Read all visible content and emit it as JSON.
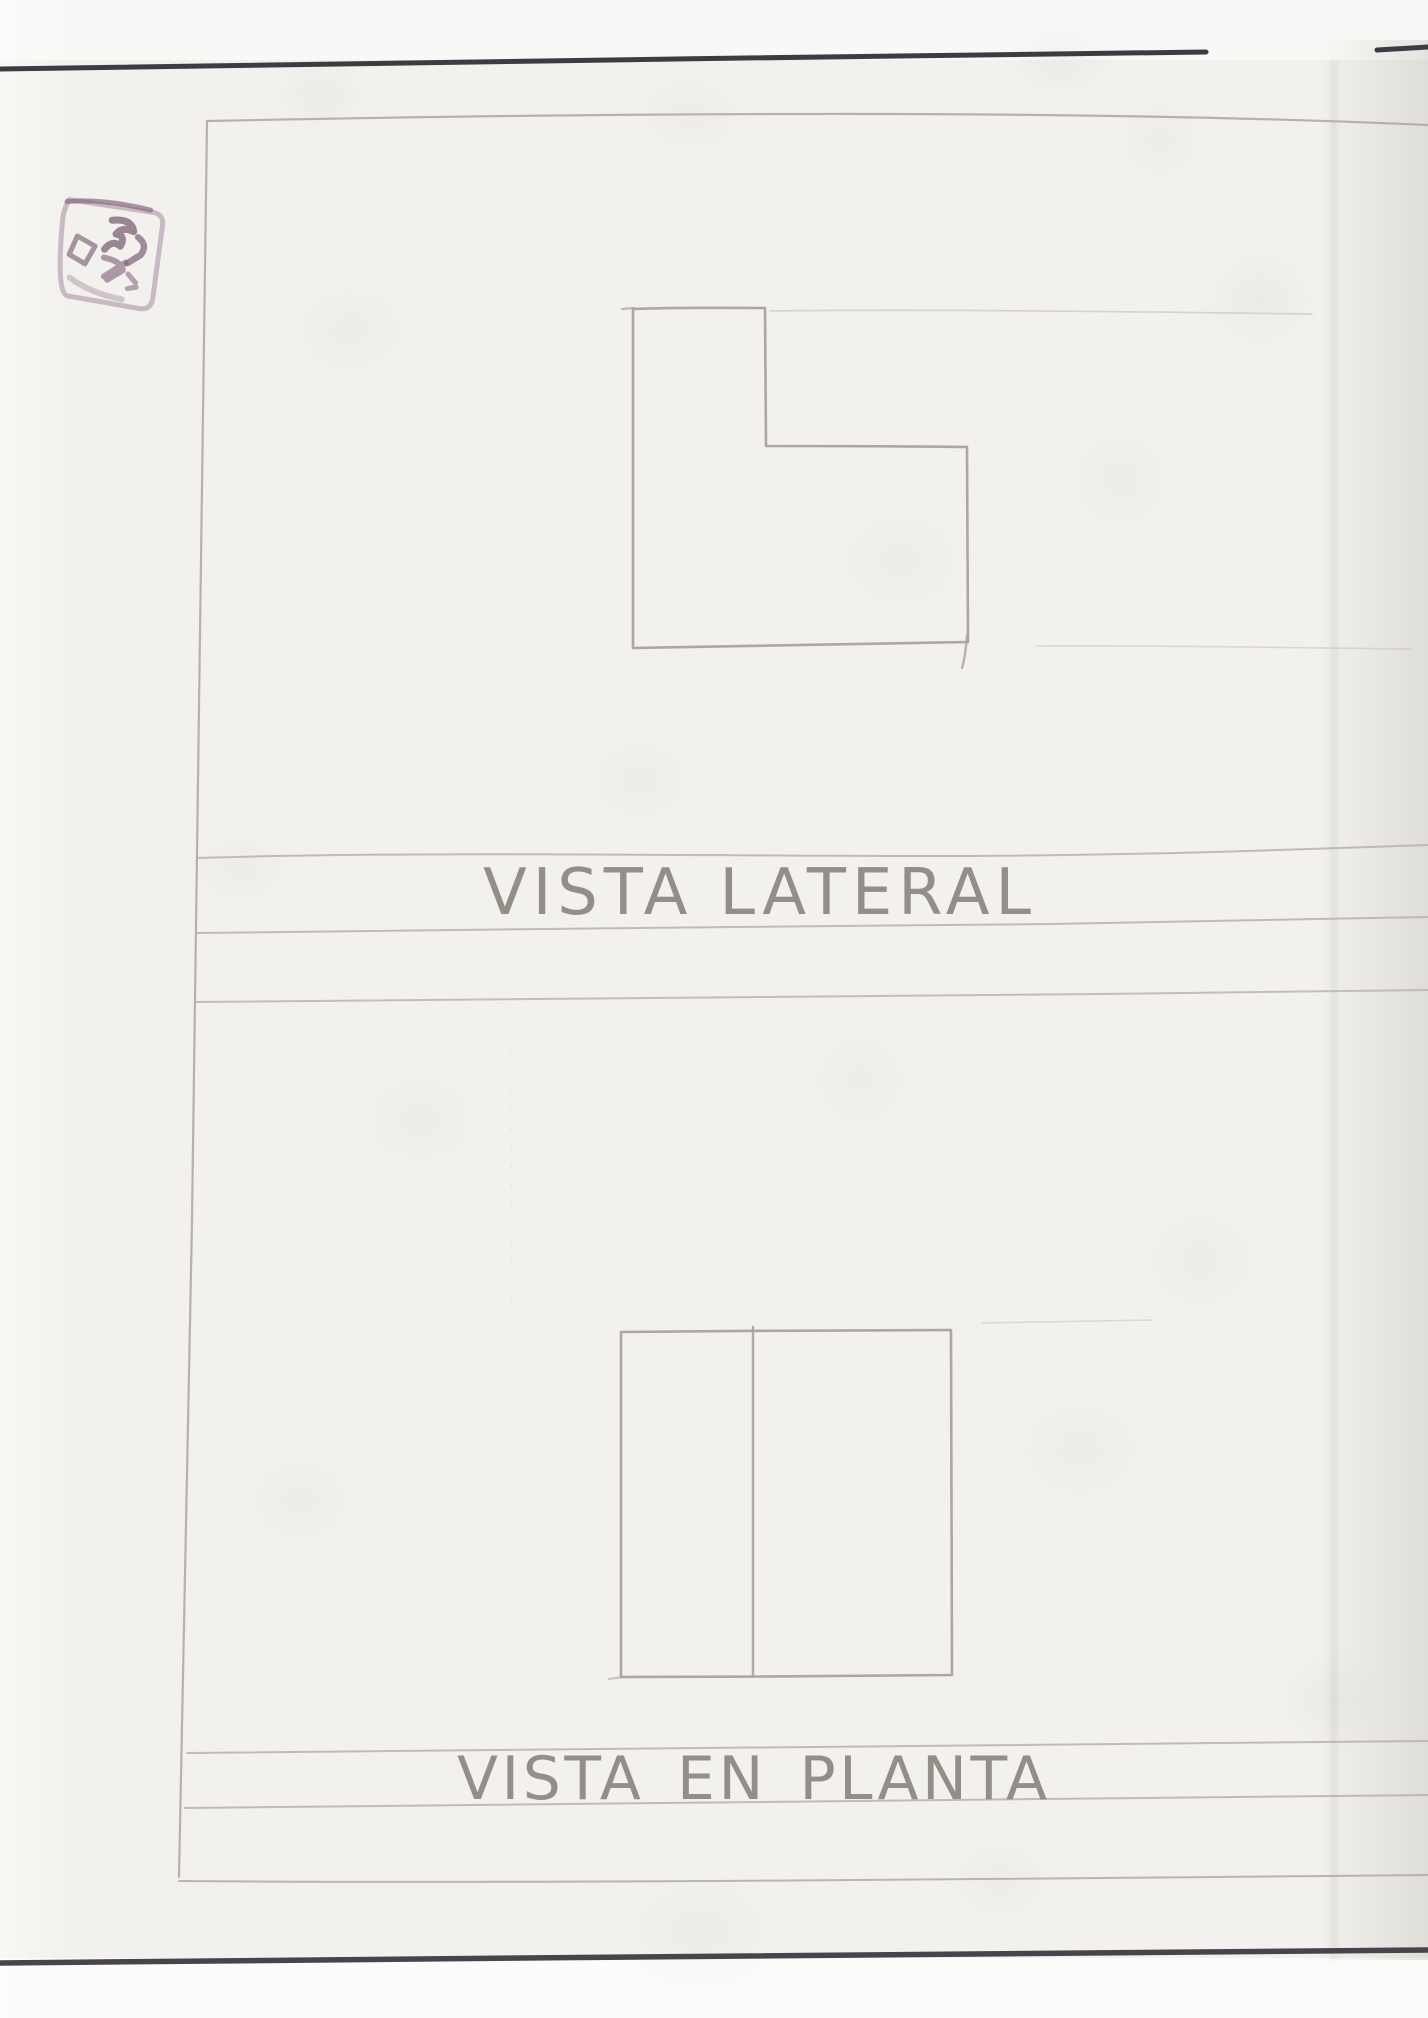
{
  "labels": {
    "side_view": "VISTA LATERAL",
    "plan_view": "VISTA EN PLANTA"
  },
  "stamp": {
    "ink_color": "#8a6a82",
    "legible": false,
    "border_d": "M -44,-52 L 40,-46 Q 52,-45 51,-33 L 47,40 Q 46,52 34,51 L -38,44 Q -50,43 -49,-31 Q -49,-42 -44,-52 Z",
    "border_accent_d": "M -46,-50 Q -10,-56 38,-48",
    "marks": [
      "M -8,-34 Q 10,-42 16,-30 Q 4,-32 0,-22 Q 10,-24 8,-12 Q -2,-16 -6,-4",
      "M 22,-26 Q 34,-22 30,-10 L 20,2",
      "M -36,-8 L -16,-4 L -20,16 L -38,12 Z",
      "M -4,4 Q 14,2 18,10 L 6,24 M 18,2 L 2,22",
      "M 24,12 L 34,18 M 28,26 L 36,22",
      "M -30,34 Q -6,42 26,38"
    ]
  },
  "colors": {
    "paper": "#f2f1ed",
    "paper_top_strip": "#f8f8f6",
    "paper_bottom_strip": "#fbfbfa",
    "page_edge_line_top": "#3f3b43",
    "page_edge_line_bottom": "#49444c",
    "pencil_figure": "#a9a29c",
    "pencil_frame": "#b0aaa4",
    "pencil_band": "#b7b1ab",
    "pencil_faint": "#c6c1bb",
    "handwriting": "#8d8680",
    "stamp_ink": "#8a6a82"
  },
  "geometry": {
    "page_edge_top_a": "M0,69 C 350,63 820,57 1206,52",
    "page_edge_top_b": "M1377,50 C 1395,49 1412,48 1428,47",
    "page_edge_bottom": "M0,1963 C 450,1959 1000,1953 1428,1950",
    "frame": {
      "left": "M207,121 C 201,600 193,1300 179,1877",
      "top": "M207,121 C 550,114 1050,108 1428,125",
      "bottom": "M179,1881 C 500,1884 1000,1879 1428,1875"
    },
    "side_section": {
      "figure_outline": "M633,309 C 680,307 740,308 765,308 L 766,446 C 830,446 900,446 967,447 L 968,642 C 860,644 740,646 633,648 Z",
      "figure_tail": "M967,636 C 966,648 965,658 962,668",
      "figure_top_overshoot": "M622,309 L 634,308",
      "construction_top": "M770,311 C 950,309 1150,312 1312,314",
      "construction_bottom": "M1036,646 C 1150,645 1300,648 1412,649",
      "band_line_1": "M197,858 C 420,851 700,856 920,856 C 1150,856 1300,849 1428,845",
      "band_line_2": "M196,933 C 450,928 800,928 1050,924 C 1250,921 1350,918 1428,917",
      "band_line_3": "M195,1002 C 450,999 800,997 1100,994 C 1250,992 1350,991 1428,990"
    },
    "plan_section": {
      "figure_outline": "M621,1332 C 730,1331 850,1330 951,1330 L 952,1675 C 850,1676 730,1677 621,1677 Z",
      "figure_divider": "M753,1327 C 753,1450 753,1560 753,1676",
      "figure_overshoot": "M609,1679 L 623,1677",
      "construction_top": "M982,1323 C 1040,1322 1100,1321 1152,1320",
      "band_top": "M187,1753 C 500,1748 900,1746 1428,1741",
      "band_bottom": "M185,1808 C 500,1804 900,1800 1428,1795"
    },
    "mid_crease": "M510,1050 C 511,1140 512,1240 512,1330"
  }
}
